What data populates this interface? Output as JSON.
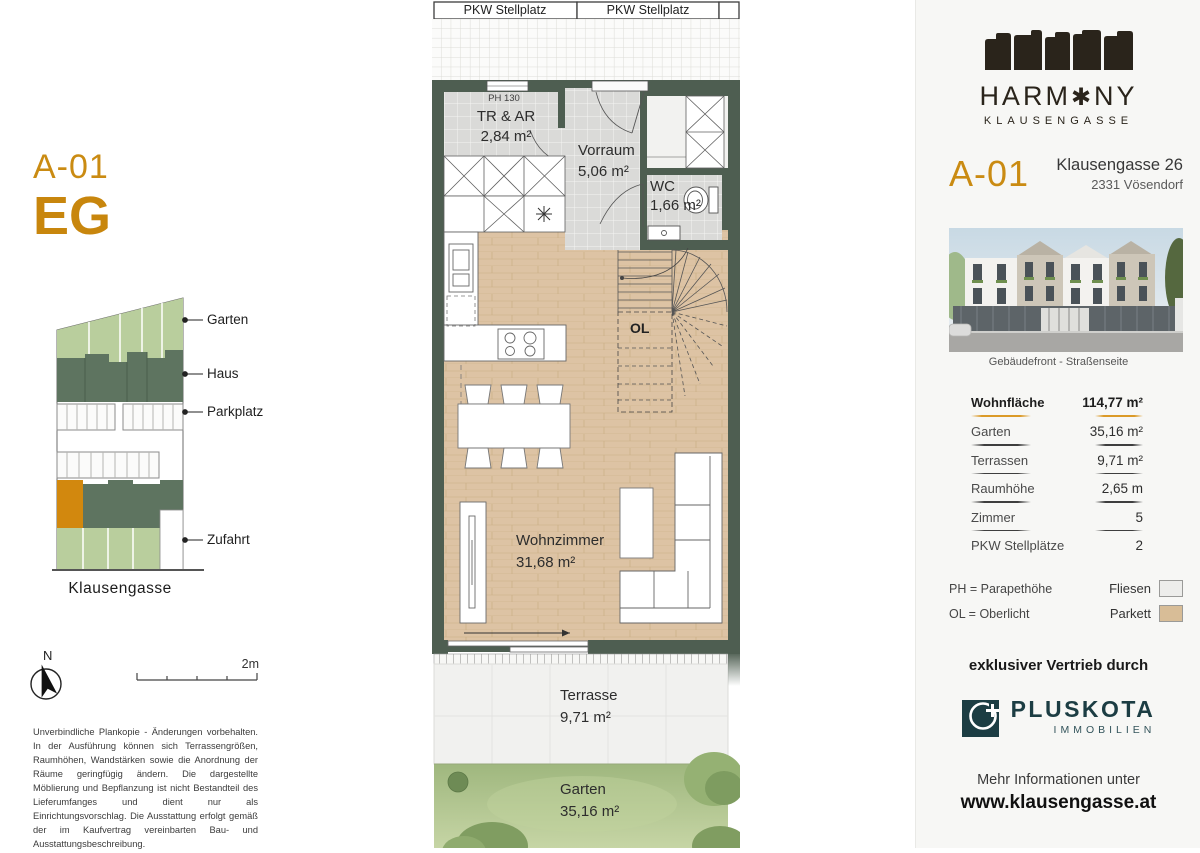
{
  "colors": {
    "accent_gold": "#CA8B12",
    "wall_green": "#4E5E51",
    "site_light_green": "#B9CE9D",
    "site_dark_green": "#5E7460",
    "site_orange": "#D2880E",
    "parquet": "#DDC3A4",
    "tile_gray": "#DBDBD9",
    "broker_teal": "#1C3D43",
    "brand_dark": "#2A241B"
  },
  "left": {
    "unit_code": "A-01",
    "floor_code": "EG",
    "site_legend": [
      "Garten",
      "Haus",
      "Parkplatz",
      "Zufahrt"
    ],
    "street_label": "Klausengasse",
    "north_label": "N",
    "scale_label": "2m",
    "disclaimer": "Unverbindliche Plankopie - Änderungen vorbehalten. In der Ausführung können sich Terrassengrößen, Raumhöhen, Wandstärken sowie die Anordnung der Räume geringfügig ändern. Die dargestellte Möblierung und Bepflanzung ist nicht Bestandteil des Lieferumfanges und dient nur als Einrichtungsvorschlag. Die Ausstattung erfolgt gemäß der im Kaufvertrag vereinbarten Bau- und Ausstattungsbeschreibung."
  },
  "plan": {
    "stellplatz": [
      "PKW Stellplatz",
      "PKW Stellplatz"
    ],
    "ph_label": "PH 130",
    "ol_label": "OL",
    "rooms": {
      "tr_ar": {
        "name": "TR & AR",
        "area": "2,84 m²"
      },
      "vorraum": {
        "name": "Vorraum",
        "area": "5,06 m²"
      },
      "wc": {
        "name": "WC",
        "area": "1,66 m²"
      },
      "wohnzimmer": {
        "name": "Wohnzimmer",
        "area": "31,68 m²"
      },
      "terrasse": {
        "name": "Terrasse",
        "area": "9,71 m²"
      },
      "garten": {
        "name": "Garten",
        "area": "35,16 m²"
      }
    }
  },
  "panel": {
    "brand": {
      "left": "HARM",
      "flower": "✱",
      "right": "NY",
      "sub": "KLAUSENGASSE"
    },
    "unit_code": "A-01",
    "address1": "Klausengasse 26",
    "address2": "2331 Vösendorf",
    "photo_caption": "Gebäudefront - Straßenseite",
    "specs": [
      {
        "label": "Wohnfläche",
        "value": "114,77 m²"
      },
      {
        "label": "Garten",
        "value": "35,16 m²"
      },
      {
        "label": "Terrassen",
        "value": "9,71 m²"
      },
      {
        "label": "Raumhöhe",
        "value": "2,65 m"
      },
      {
        "label": "Zimmer",
        "value": "5"
      },
      {
        "label": "PKW Stellplätze",
        "value": "2"
      }
    ],
    "abbr1": "PH = Parapethöhe",
    "abbr2": "OL = Oberlicht",
    "mat1": "Fliesen",
    "mat2": "Parkett",
    "distribution": "exklusiver Vertrieb durch",
    "broker": {
      "name": "PLUSKOTA",
      "sub": "IMMOBILIEN"
    },
    "more_info": "Mehr Informationen unter",
    "website": "www.klausengasse.at"
  }
}
